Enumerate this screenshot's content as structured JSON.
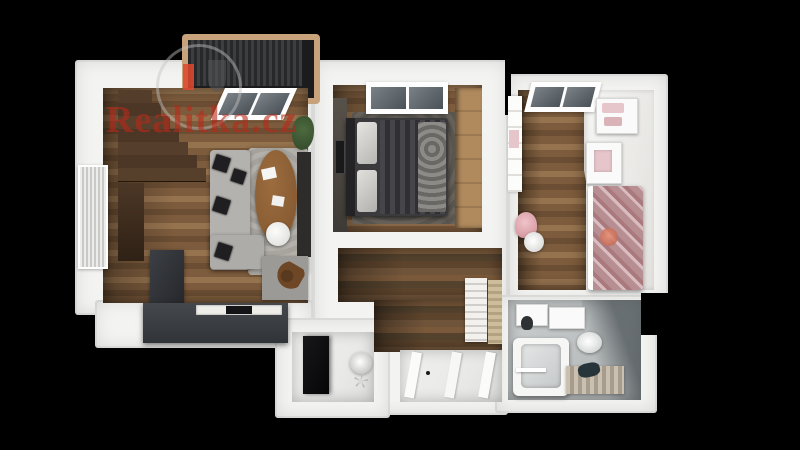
{
  "watermark": {
    "text": "Realitka.cz",
    "logo_icon": "house-in-circle-icon"
  },
  "scene": {
    "description": "3D rendered top-down cutaway floor plan of an apartment on a black background",
    "rooms": [
      "balcony",
      "living-room-with-kitchen",
      "staircase",
      "bedroom",
      "children-room",
      "hallway",
      "closet-room",
      "entry",
      "bathroom"
    ]
  },
  "colors": {
    "bg": "#000000",
    "wall": "#f3f3f1",
    "wallShade": "#dcdad7",
    "woodLight": "#96734f",
    "wood": "#7d5c3d",
    "woodDark": "#55432e",
    "stairWood": "#4c3726",
    "kitchenDark": "#3a3d41",
    "sofaGray": "#b4b2ae",
    "rugGray": "#a9a7a3",
    "tableWood": "#8a5c33",
    "bedDark": "#3b3b3d",
    "bedroomRug": "#595650",
    "cork": "#b08a5d",
    "darkPanel": "#2e2c2a",
    "pinkBed": "#b78f93",
    "pinkLight": "#e6c6ca",
    "bathFloor": "#bcc0c1",
    "bathWall": "#838a8d",
    "balconyFrame": "#c7a27b",
    "slatDark": "#27282a",
    "plantGreen": "#39502f",
    "floorWhite": "#e9e9e7",
    "logoRed": "#e0482e",
    "watermarkRed": "rgba(185,40,25,0.6)"
  }
}
